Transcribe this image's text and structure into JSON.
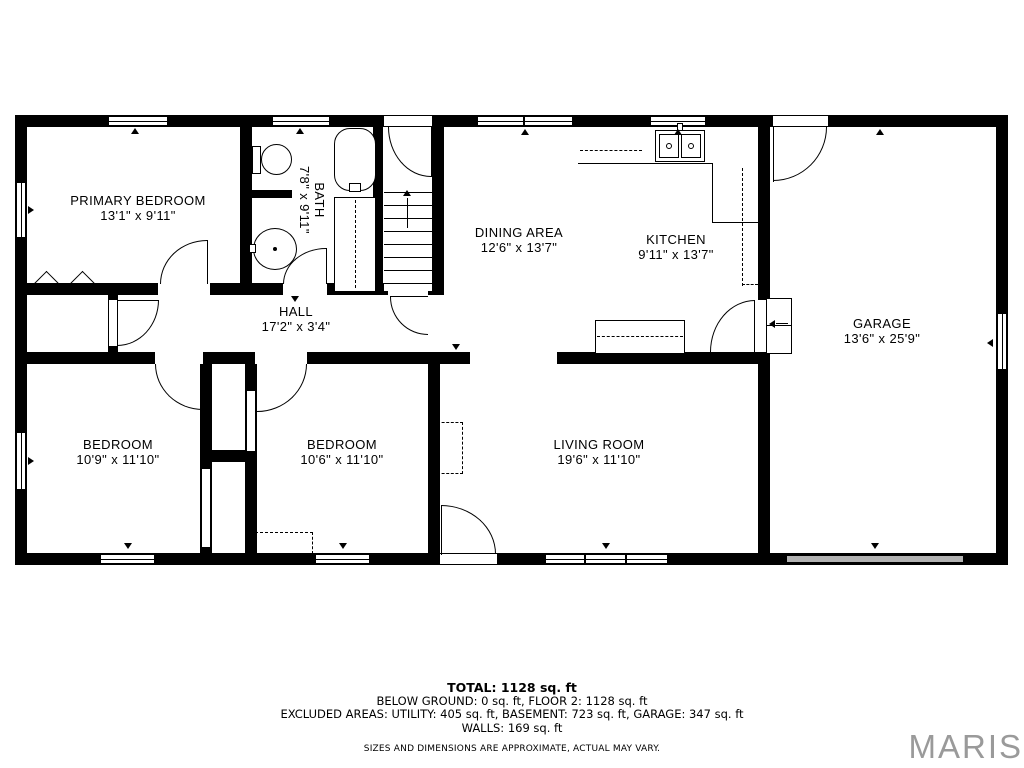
{
  "rooms": {
    "primary": {
      "name": "PRIMARY BEDROOM",
      "dims": "13'1\" x 9'11\""
    },
    "bath": {
      "name": "BATH",
      "dims": "7'8\" x 9'11\""
    },
    "hall": {
      "name": "HALL",
      "dims": "17'2\" x 3'4\""
    },
    "dining": {
      "name": "DINING AREA",
      "dims": "12'6\" x 13'7\""
    },
    "kitchen": {
      "name": "KITCHEN",
      "dims": "9'11\" x 13'7\""
    },
    "garage": {
      "name": "GARAGE",
      "dims": "13'6\" x 25'9\""
    },
    "bedroom1": {
      "name": "BEDROOM",
      "dims": "10'9\" x 11'10\""
    },
    "bedroom2": {
      "name": "BEDROOM",
      "dims": "10'6\" x 11'10\""
    },
    "living": {
      "name": "LIVING ROOM",
      "dims": "19'6\" x 11'10\""
    }
  },
  "summary": {
    "total": "TOTAL: 1128 sq. ft",
    "line2": "BELOW GROUND: 0 sq. ft, FLOOR 2: 1128 sq. ft",
    "line3": "EXCLUDED AREAS: UTILITY: 405 sq. ft, BASEMENT: 723 sq. ft, GARAGE: 347 sq. ft",
    "line4": "WALLS: 169 sq. ft",
    "disclaimer": "SIZES AND DIMENSIONS ARE APPROXIMATE, ACTUAL MAY VARY."
  },
  "branding": {
    "logo_text": "MARIS",
    "logo_color": "#9a9a9a"
  }
}
